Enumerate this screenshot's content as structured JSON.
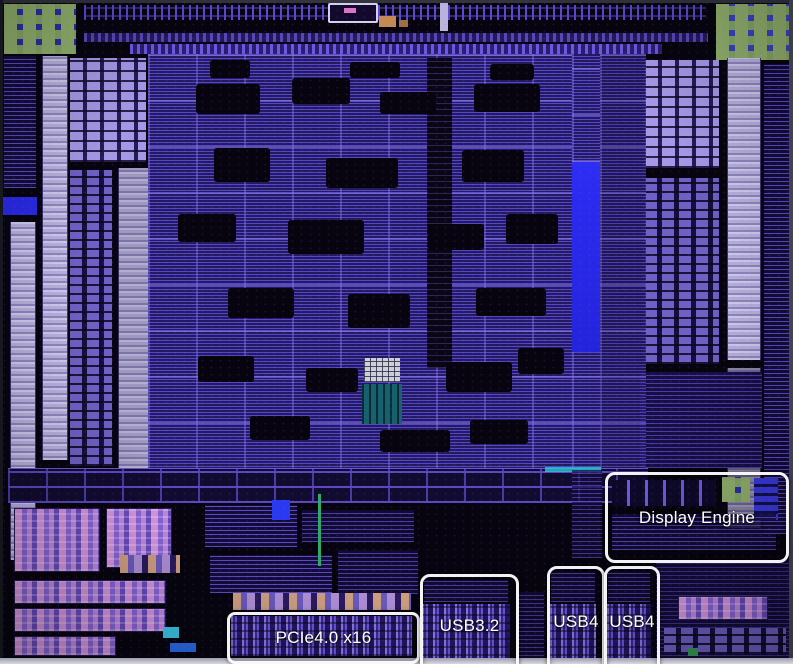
{
  "annotations": [
    {
      "id": "pcie",
      "label": "PCIe4.0 x16"
    },
    {
      "id": "usb32",
      "label": "USB3.2"
    },
    {
      "id": "usb4-left",
      "label": "USB4"
    },
    {
      "id": "usb4-right",
      "label": "USB4"
    },
    {
      "id": "display-engine",
      "label": "Display Engine"
    }
  ],
  "colors": {
    "background": "#07040f",
    "die_logic_purple": "#30226e",
    "memory_lavender": "#a598e6",
    "phy_strip_lavender": "#bfb8e4",
    "highlight_blue": "#2b2bee",
    "pad_green": "#93b26e",
    "analog_pink": "#d796e0",
    "teal_block": "#15616e",
    "annotation_border": "#f2f2f6",
    "annotation_text": "#ffffff"
  }
}
